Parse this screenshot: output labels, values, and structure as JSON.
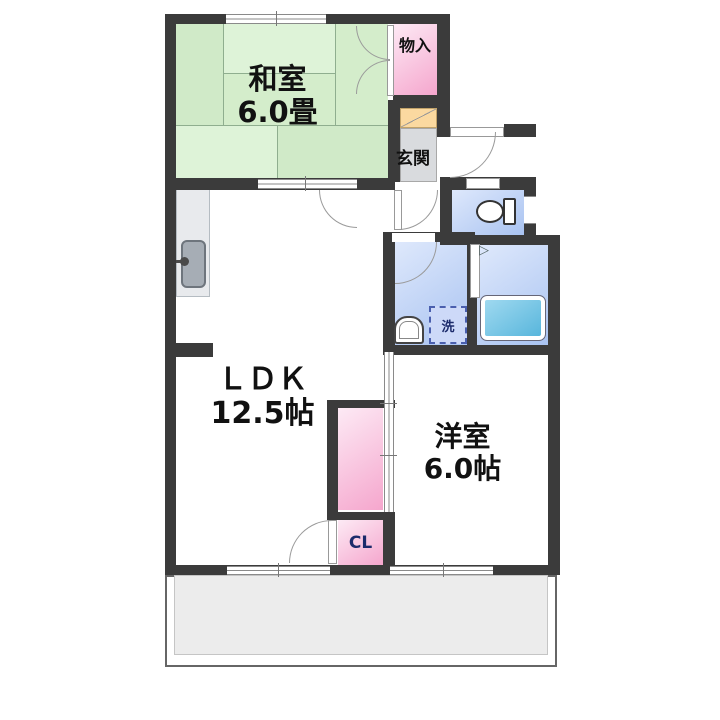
{
  "plan_title": "apartment-floor-plan",
  "rooms": {
    "washitsu": {
      "name": "和室",
      "size": "6.0畳"
    },
    "ldk": {
      "name": "ＬＤＫ",
      "size": "12.5帖"
    },
    "yoshitsu": {
      "name": "洋室",
      "size": "6.0帖"
    },
    "genkan": {
      "label": "玄関"
    },
    "monoire": {
      "label": "物入"
    },
    "closet": {
      "label": "CL"
    },
    "laundry": {
      "label": "洗"
    }
  },
  "colors": {
    "wall": "#3b3b3b",
    "line": "#8a8a8a",
    "tatami-line": "#8fae8f",
    "tatami-a": "#d0eac8",
    "tatami-b": "#def3d8",
    "tatami-c": "#d4edcb",
    "pink-light": "#fdeaf5",
    "pink": "#f5a6cd",
    "blue-light": "#dfe9fc",
    "blue": "#a9c3f1",
    "tub-light": "#9fd9f0",
    "tub": "#58b6dc",
    "genkan-floor": "#d9dbde",
    "shoe-cabinet": "#fbd9a0",
    "balcony": "#ececec",
    "counter": "#e8eaed",
    "sink": "#a6adb5",
    "navy": "#1c2b6b"
  }
}
